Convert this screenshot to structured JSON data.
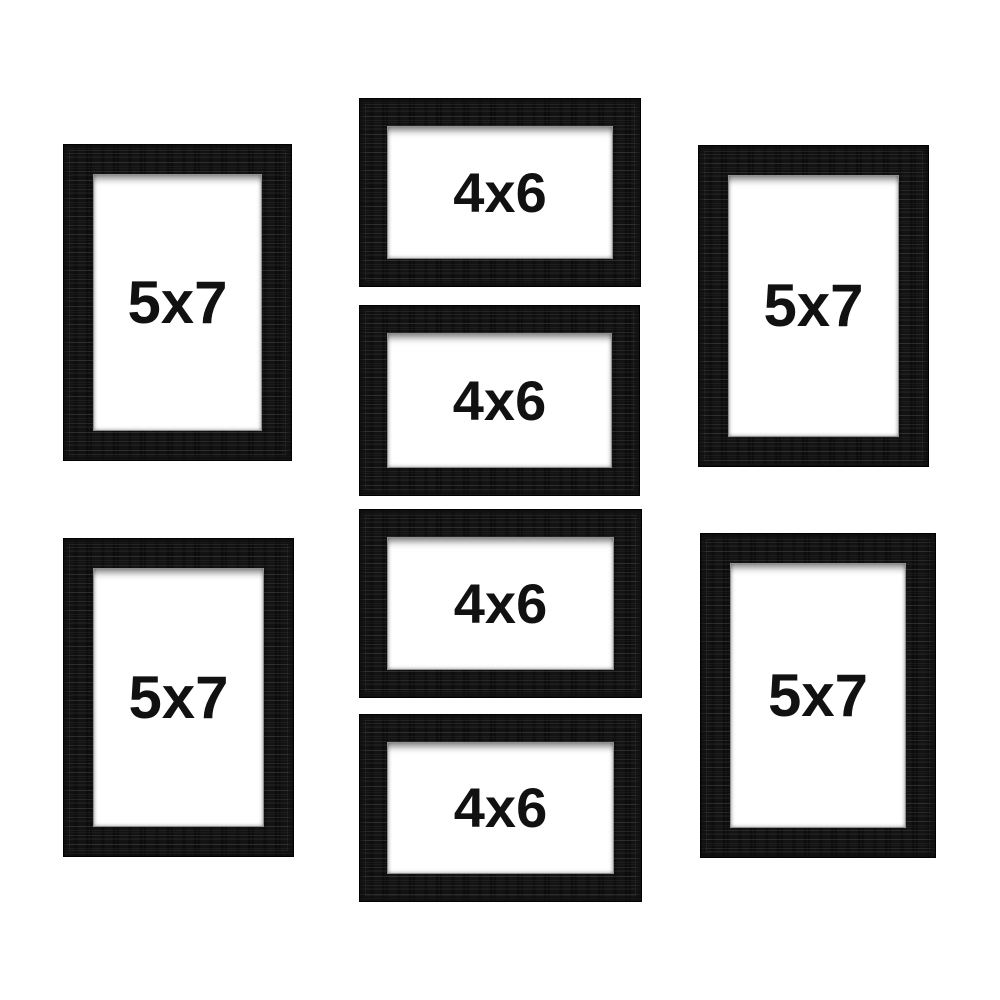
{
  "product_image": {
    "background_color": "#ffffff",
    "frame_color": "#131313",
    "mat_color": "#ffffff",
    "label_color": "#111111",
    "frames": [
      {
        "label": "5x7",
        "orientation": "portrait",
        "position": "top-left"
      },
      {
        "label": "4x6",
        "orientation": "landscape",
        "position": "center-row-1"
      },
      {
        "label": "5x7",
        "orientation": "portrait",
        "position": "top-right"
      },
      {
        "label": "4x6",
        "orientation": "landscape",
        "position": "center-row-2"
      },
      {
        "label": "4x6",
        "orientation": "landscape",
        "position": "center-row-3"
      },
      {
        "label": "5x7",
        "orientation": "portrait",
        "position": "bottom-left"
      },
      {
        "label": "4x6",
        "orientation": "landscape",
        "position": "center-row-4"
      },
      {
        "label": "5x7",
        "orientation": "portrait",
        "position": "bottom-right"
      }
    ]
  }
}
